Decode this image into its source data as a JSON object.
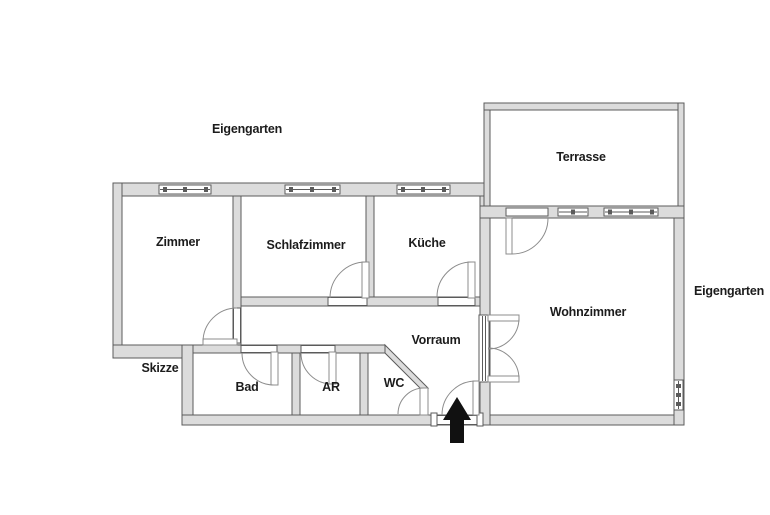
{
  "rooms": {
    "zimmer": "Zimmer",
    "schlafzimmer": "Schlafzimmer",
    "kueche": "Küche",
    "wohnzimmer": "Wohnzimmer",
    "terrasse": "Terrasse",
    "vorraum": "Vorraum",
    "bad": "Bad",
    "ar": "AR",
    "wc": "WC"
  },
  "annotations": {
    "eigengarten_top": "Eigengarten",
    "eigengarten_right": "Eigengarten",
    "skizze": "Skizze"
  },
  "icons": {
    "entrance_arrow": "up-arrow"
  },
  "colors": {
    "background": "#ffffff",
    "wall_fill": "#dcdcdc",
    "wall_outline": "#5b5b5b",
    "line": "#8c8c8c",
    "text": "#1c1c1c",
    "arrow": "#111111"
  }
}
